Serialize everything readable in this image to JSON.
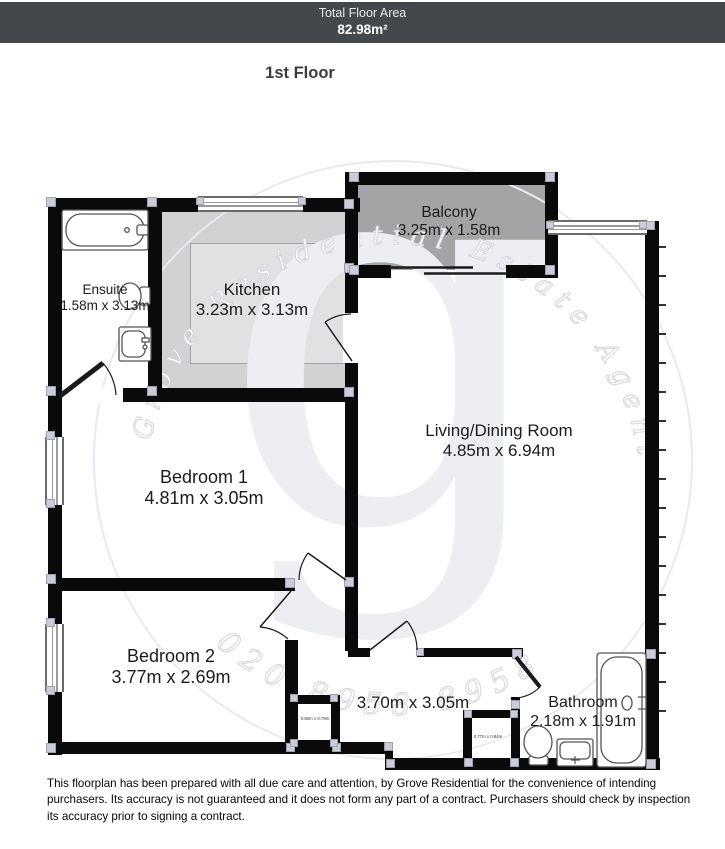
{
  "banner": {
    "label": "Total Floor Area",
    "value": "82.98m²"
  },
  "floor_title": "1st Floor",
  "rooms": {
    "ensuite": {
      "name": "Ensuite",
      "dims": "1.58m x 3.13m"
    },
    "kitchen": {
      "name": "Kitchen",
      "dims": "3.23m x 3.13m"
    },
    "balcony": {
      "name": "Balcony",
      "dims": "3.25m x 1.58m"
    },
    "living": {
      "name": "Living/Dining Room",
      "dims": "4.85m x 6.94m"
    },
    "bedroom1": {
      "name": "Bedroom 1",
      "dims": "4.81m x 3.05m"
    },
    "bedroom2": {
      "name": "Bedroom 2",
      "dims": "3.77m x 2.69m"
    },
    "hallway": {
      "dims": "3.70m x 3.05m"
    },
    "bathroom": {
      "name": "Bathroom",
      "dims": "2.18m x 1.91m"
    },
    "store_bedroom2": {
      "dims": "0.80m x 0.79m"
    },
    "store_hall": {
      "dims": "0.77m x 0.84m"
    }
  },
  "watermark": {
    "arc_text": "Grove Residential Estate Agents",
    "phone": "020 8958 8958",
    "monogram": "g"
  },
  "colors": {
    "banner_bg": "#44484c",
    "wall": "#0a0a0a",
    "kitchen_fill": "#d2d2d4",
    "balcony_fill": "#a4a4a7",
    "corner_joint": "#cbccda"
  },
  "disclaimer": "This floorplan has been prepared with all due care and attention, by Grove Residential for the convenience of intending purchasers. Its accuracy is not guaranteed and it does not form any part of a contract. Purchasers should check by inspection its accuracy prior to signing a contract."
}
